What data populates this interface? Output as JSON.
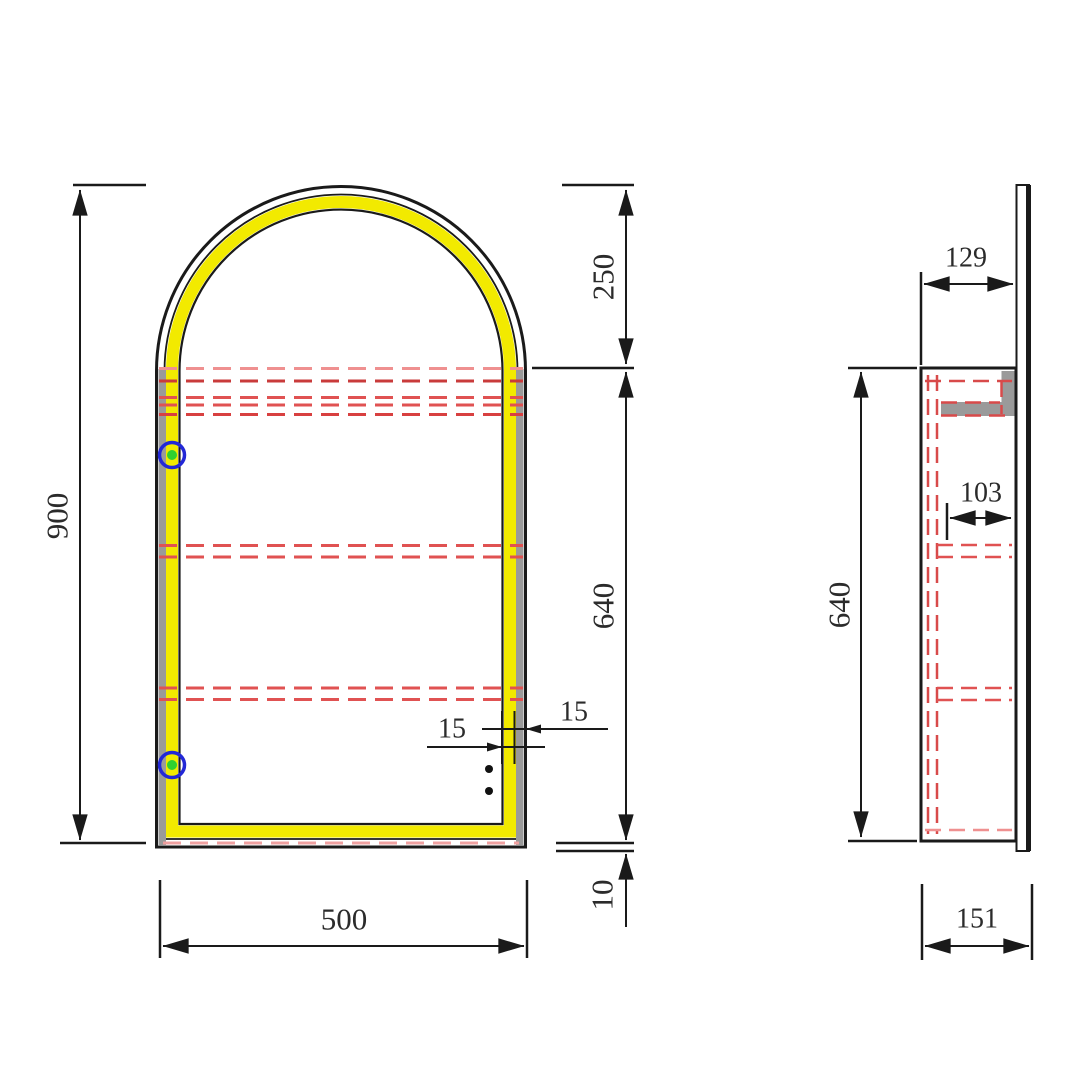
{
  "drawing": {
    "front_view": {
      "overall_height_mm": "900",
      "overall_width_mm": "500",
      "arch_height_mm": "250",
      "carcass_height_mm": "640",
      "bottom_offset_mm": "10",
      "frame_width_mm": "15",
      "led_strip_width_mm": "15"
    },
    "side_view": {
      "inner_depth_mm": "129",
      "shelf_depth_mm": "103",
      "carcass_height_mm": "640",
      "overall_depth_mm": "151"
    }
  },
  "colors": {
    "outline_black": "#1a1a1a",
    "led_yellow": "#f2ea00",
    "hidden_line_red": "#d94a4a",
    "hidden_line_pink": "#ef9090",
    "hinge_ring_blue": "#2328d6",
    "hinge_dot_green": "#2fd12f",
    "shade_gray": "#9a9a9a"
  }
}
